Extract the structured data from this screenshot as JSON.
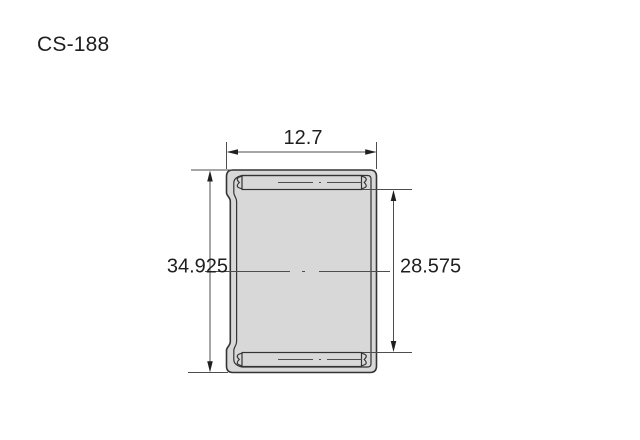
{
  "title": "CS-188",
  "drawing": {
    "dimensions": {
      "width_top": "12.7",
      "outer_diameter": "34.925",
      "inner_diameter": "28.575"
    },
    "colors": {
      "line": "#333333",
      "dimension_line": "#4d4d4d",
      "shell_fill": "#d8d8d8",
      "interior_fill": "#ffffff",
      "text": "#1f1f1f",
      "background": "#ffffff"
    }
  }
}
